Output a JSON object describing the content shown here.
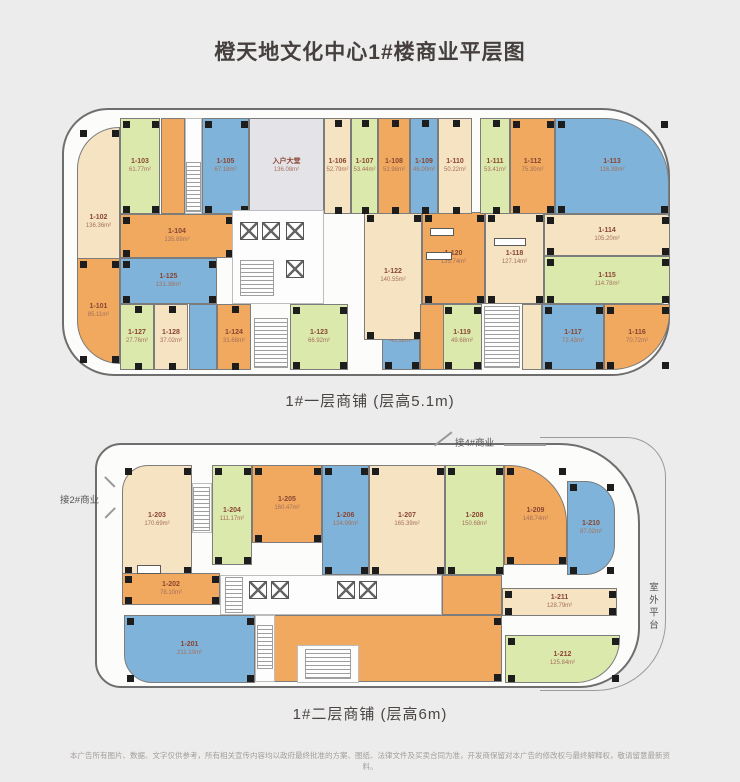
{
  "title": "橙天地文化中心1#楼商业平层图",
  "colors": {
    "cream": "#f5e3c2",
    "green": "#dce9ad",
    "orange": "#f0a95f",
    "blue": "#7fb3d9",
    "lobby": "#e4e4e8",
    "label_id": "#8a4632",
    "label_area": "#a5705c",
    "background": "#ececec",
    "outline": "#6e6e6e",
    "column": "#1d1d1d"
  },
  "floor1": {
    "caption": "1#一层商铺 (层高5.1m)",
    "units": [
      {
        "id": "1-102",
        "area": "136.36m²",
        "color": "cream",
        "rect": [
          13,
          17,
          43,
          190
        ],
        "radius": "42px 0 0 0"
      },
      {
        "id": "1-103",
        "area": "61.77m²",
        "color": "green",
        "rect": [
          56,
          8,
          40,
          96
        ]
      },
      {
        "id": "1-105",
        "area": "67.18m²",
        "color": "blue",
        "rect": [
          138,
          8,
          47,
          96
        ]
      },
      {
        "id": "入户大堂",
        "area": "136.08m²",
        "color": "lobby",
        "rect": [
          185,
          8,
          75,
          96
        ],
        "nocols": true
      },
      {
        "id": "1-104",
        "area": "135.89m²",
        "color": "orange",
        "rect": [
          56,
          104,
          114,
          44
        ]
      },
      {
        "id": "1-125",
        "area": "131.38m²",
        "color": "blue",
        "rect": [
          56,
          148,
          97,
          46
        ]
      },
      {
        "id": "1-101",
        "area": "85.11m²",
        "color": "orange",
        "rect": [
          13,
          148,
          43,
          106
        ],
        "radius": "0 0 0 46px"
      },
      {
        "id": "1-127",
        "area": "27.76m²",
        "color": "green",
        "rect": [
          56,
          194,
          34,
          66
        ]
      },
      {
        "id": "1-128",
        "area": "37.02m²",
        "color": "cream",
        "rect": [
          90,
          194,
          34,
          66
        ]
      },
      {
        "id": "1-124",
        "area": "31.68m²",
        "color": "orange",
        "rect": [
          153,
          194,
          34,
          66
        ]
      },
      {
        "id": "1-123",
        "area": "66.92m²",
        "color": "green",
        "rect": [
          226,
          194,
          58,
          66
        ]
      },
      {
        "id": "1-121",
        "area": "41.32m²",
        "color": "blue",
        "rect": [
          318,
          194,
          38,
          66
        ]
      },
      {
        "id": "1-119",
        "area": "49.68m²",
        "color": "green",
        "rect": [
          378,
          194,
          40,
          66
        ]
      },
      {
        "id": "1-117",
        "area": "72.43m²",
        "color": "blue",
        "rect": [
          478,
          194,
          62,
          66
        ]
      },
      {
        "id": "1-116",
        "area": "70.72m²",
        "color": "orange",
        "rect": [
          540,
          194,
          66,
          66
        ],
        "radius": "0 0 58px 0"
      },
      {
        "id": "1-122",
        "area": "140.55m²",
        "color": "cream",
        "rect": [
          300,
          102,
          58,
          128
        ]
      },
      {
        "id": "1-120",
        "area": "135.74m²",
        "color": "orange",
        "rect": [
          358,
          102,
          63,
          92
        ]
      },
      {
        "id": "1-118",
        "area": "127.14m²",
        "color": "cream",
        "rect": [
          421,
          102,
          59,
          92
        ]
      },
      {
        "id": "1-106",
        "area": "52.79m²",
        "color": "cream",
        "rect": [
          260,
          8,
          27,
          96
        ]
      },
      {
        "id": "1-107",
        "area": "53.44m²",
        "color": "green",
        "rect": [
          287,
          8,
          27,
          96
        ]
      },
      {
        "id": "1-108",
        "area": "52.98m²",
        "color": "orange",
        "rect": [
          314,
          8,
          32,
          96
        ]
      },
      {
        "id": "1-109",
        "area": "46.00m²",
        "color": "blue",
        "rect": [
          346,
          8,
          28,
          96
        ]
      },
      {
        "id": "1-110",
        "area": "50.22m²",
        "color": "cream",
        "rect": [
          374,
          8,
          34,
          96
        ]
      },
      {
        "id": "1-111",
        "area": "53.41m²",
        "color": "green",
        "rect": [
          416,
          8,
          30,
          96
        ]
      },
      {
        "id": "1-112",
        "area": "75.30m²",
        "color": "orange",
        "rect": [
          446,
          8,
          45,
          96
        ]
      },
      {
        "id": "1-113",
        "area": "116.39m²",
        "color": "blue",
        "rect": [
          491,
          8,
          114,
          96
        ],
        "radius": "0 64px 0 0"
      },
      {
        "id": "1-114",
        "area": "105.20m²",
        "color": "cream",
        "rect": [
          480,
          104,
          126,
          42
        ],
        "radius": "0 4px 0 0"
      },
      {
        "id": "1-115",
        "area": "114.78m²",
        "color": "green",
        "rect": [
          480,
          146,
          126,
          48
        ],
        "radius": "0 0 10px 0"
      }
    ],
    "patches": [
      {
        "type": "fill",
        "color": "orange",
        "rect": [
          97,
          8,
          24,
          96
        ]
      },
      {
        "type": "white",
        "rect": [
          121,
          8,
          17,
          96
        ]
      },
      {
        "type": "stair",
        "rect": [
          122,
          52,
          15,
          50
        ]
      },
      {
        "type": "white",
        "rect": [
          168,
          100,
          92,
          94
        ]
      },
      {
        "type": "elev",
        "rect": [
          176,
          112,
          18,
          18
        ]
      },
      {
        "type": "elev",
        "rect": [
          198,
          112,
          18,
          18
        ]
      },
      {
        "type": "elev",
        "rect": [
          222,
          112,
          18,
          18
        ]
      },
      {
        "type": "stair",
        "rect": [
          176,
          150,
          34,
          36
        ]
      },
      {
        "type": "elev",
        "rect": [
          222,
          150,
          18,
          18
        ]
      },
      {
        "type": "fill",
        "color": "blue",
        "rect": [
          125,
          194,
          28,
          66
        ]
      },
      {
        "type": "stair",
        "rect": [
          190,
          208,
          34,
          50
        ]
      },
      {
        "type": "fill",
        "color": "orange",
        "rect": [
          356,
          194,
          24,
          66
        ]
      },
      {
        "type": "stair",
        "rect": [
          420,
          196,
          36,
          62
        ]
      },
      {
        "type": "fill",
        "color": "cream",
        "rect": [
          458,
          194,
          20,
          66
        ]
      },
      {
        "type": "box",
        "rect": [
          366,
          118,
          24,
          8
        ]
      },
      {
        "type": "box",
        "rect": [
          362,
          142,
          26,
          8
        ]
      },
      {
        "type": "box",
        "rect": [
          430,
          128,
          32,
          8
        ]
      }
    ]
  },
  "floor2": {
    "caption": "1#二层商铺 (层高6m)",
    "units": [
      {
        "id": "1-203",
        "area": "170.69m²",
        "color": "cream",
        "rect": [
          25,
          20,
          70,
          110
        ],
        "radius": "26px 0 0 0"
      },
      {
        "id": "1-204",
        "area": "111.17m²",
        "color": "green",
        "rect": [
          115,
          20,
          40,
          100
        ]
      },
      {
        "id": "1-205",
        "area": "160.47m²",
        "color": "orange",
        "rect": [
          155,
          20,
          70,
          78
        ]
      },
      {
        "id": "1-206",
        "area": "124.99m²",
        "color": "blue",
        "rect": [
          225,
          20,
          47,
          110
        ]
      },
      {
        "id": "1-207",
        "area": "165.39m²",
        "color": "cream",
        "rect": [
          272,
          20,
          76,
          110
        ]
      },
      {
        "id": "1-208",
        "area": "150.68m²",
        "color": "green",
        "rect": [
          348,
          20,
          59,
          110
        ]
      },
      {
        "id": "1-209",
        "area": "148.74m²",
        "color": "orange",
        "rect": [
          407,
          20,
          63,
          100
        ],
        "radius": "0 58px 0 0"
      },
      {
        "id": "1-210",
        "area": "87.02m²",
        "color": "blue",
        "rect": [
          470,
          36,
          48,
          94
        ],
        "radius": "0 30px 30px 0"
      },
      {
        "id": "1-202",
        "area": "78.10m²",
        "color": "orange",
        "rect": [
          25,
          128,
          98,
          32
        ]
      },
      {
        "id": "1-201",
        "area": "211.10m²",
        "color": "blue",
        "rect": [
          27,
          170,
          131,
          68
        ],
        "radius": "0 0 0 28px"
      },
      {
        "id": "1-211",
        "area": "128.79m²",
        "color": "cream",
        "rect": [
          405,
          143,
          115,
          28
        ]
      },
      {
        "id": "1-212",
        "area": "125.84m²",
        "color": "green",
        "rect": [
          408,
          190,
          115,
          48
        ],
        "radius": "0 0 44px 0"
      },
      {
        "id": "1-213",
        "area": "467.68m²",
        "color": "orange",
        "rect": [
          160,
          170,
          245,
          67
        ],
        "labelpos": [
          288,
          200
        ]
      }
    ],
    "patches": [
      {
        "type": "white",
        "rect": [
          95,
          38,
          20,
          50
        ]
      },
      {
        "type": "stair",
        "rect": [
          96,
          42,
          17,
          44
        ]
      },
      {
        "type": "white",
        "rect": [
          123,
          130,
          222,
          40
        ]
      },
      {
        "type": "stair",
        "rect": [
          128,
          132,
          18,
          36
        ]
      },
      {
        "type": "elev",
        "rect": [
          152,
          136,
          18,
          18
        ]
      },
      {
        "type": "elev",
        "rect": [
          174,
          136,
          18,
          18
        ]
      },
      {
        "type": "elev",
        "rect": [
          240,
          136,
          18,
          18
        ]
      },
      {
        "type": "elev",
        "rect": [
          262,
          136,
          18,
          18
        ]
      },
      {
        "type": "fill",
        "color": "orange",
        "rect": [
          345,
          130,
          60,
          40
        ]
      },
      {
        "type": "white",
        "rect": [
          158,
          170,
          20,
          67
        ]
      },
      {
        "type": "stair",
        "rect": [
          160,
          180,
          16,
          44
        ]
      },
      {
        "type": "white",
        "rect": [
          200,
          200,
          62,
          38
        ]
      },
      {
        "type": "stair",
        "rect": [
          208,
          204,
          46,
          30
        ]
      },
      {
        "type": "box",
        "rect": [
          40,
          120,
          24,
          9
        ]
      }
    ],
    "annotations": {
      "top": "接4#商业",
      "left": "接2#商业",
      "right": "室外平台"
    }
  },
  "disclaimer": "本广告所有图片、数据、文字仅供参考，所有相关宣传内容均以政府最终批准的方案、图纸、法律文件及买卖合同为准，开发商保留对本广告的修改权与最终解释权，敬请留意最新资料。"
}
